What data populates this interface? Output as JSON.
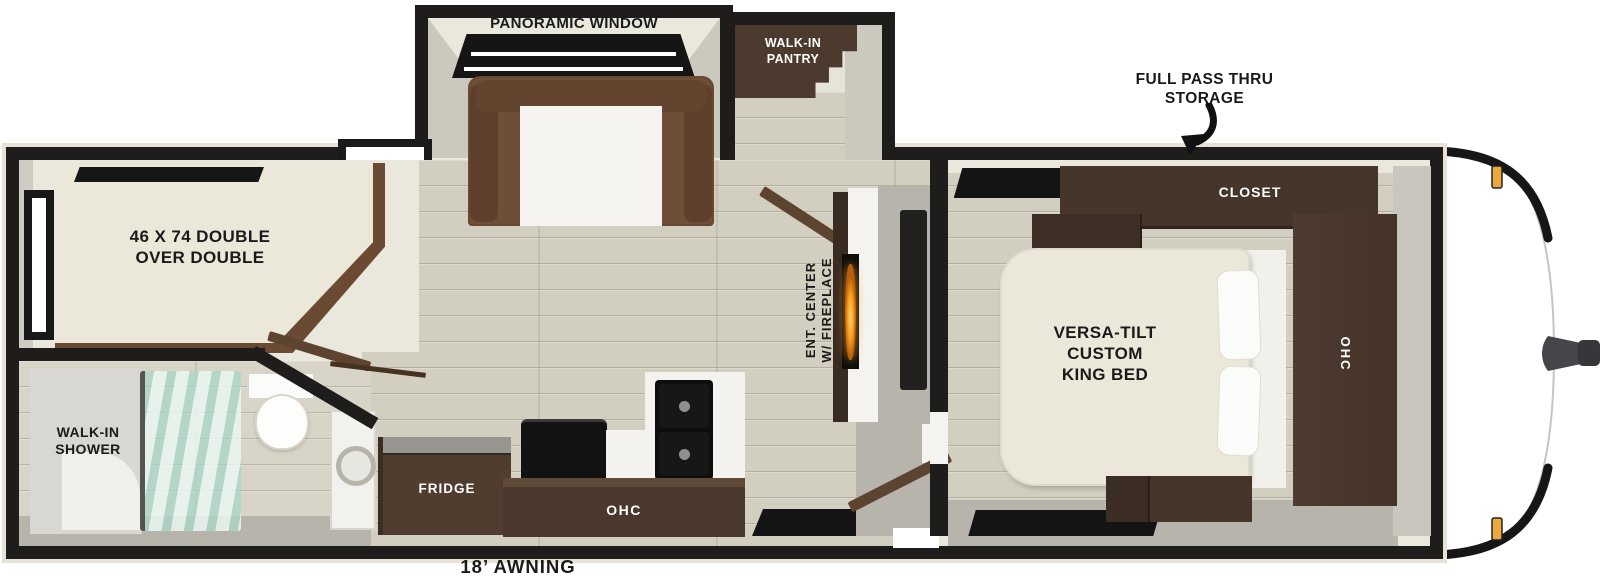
{
  "labels": {
    "panoramic_window": "PANORAMIC WINDOW",
    "walk_in_pantry": "WALK-IN\nPANTRY",
    "full_pass_thru_storage": "FULL PASS THRU\nSTORAGE",
    "closet": "CLOSET",
    "bunk_bed": "46 X 74 DOUBLE\nOVER DOUBLE",
    "king_bed": "VERSA-TILT\nCUSTOM\nKING BED",
    "bedroom_ohc": "OHC",
    "ent_center": "ENT. CENTER\nW/ FIREPLACE",
    "walk_in_shower": "WALK-IN\nSHOWER",
    "fridge": "FRIDGE",
    "kitchen_ohc": "OHC",
    "awning": "18’ AWNING"
  },
  "colors": {
    "wall": "#1e1d1b",
    "interior": "#eae7dc",
    "floor_wood": "#d3cfc0",
    "floor_gray": "#b7b4ac",
    "cabinet": "#4a382c",
    "sofa": "#6f4e37",
    "mattress": "#ebe8d9",
    "flame": "#e8901c",
    "amber": "#eaa83e",
    "label_dark": "#1a1a1a",
    "label_light": "#ffffff"
  }
}
